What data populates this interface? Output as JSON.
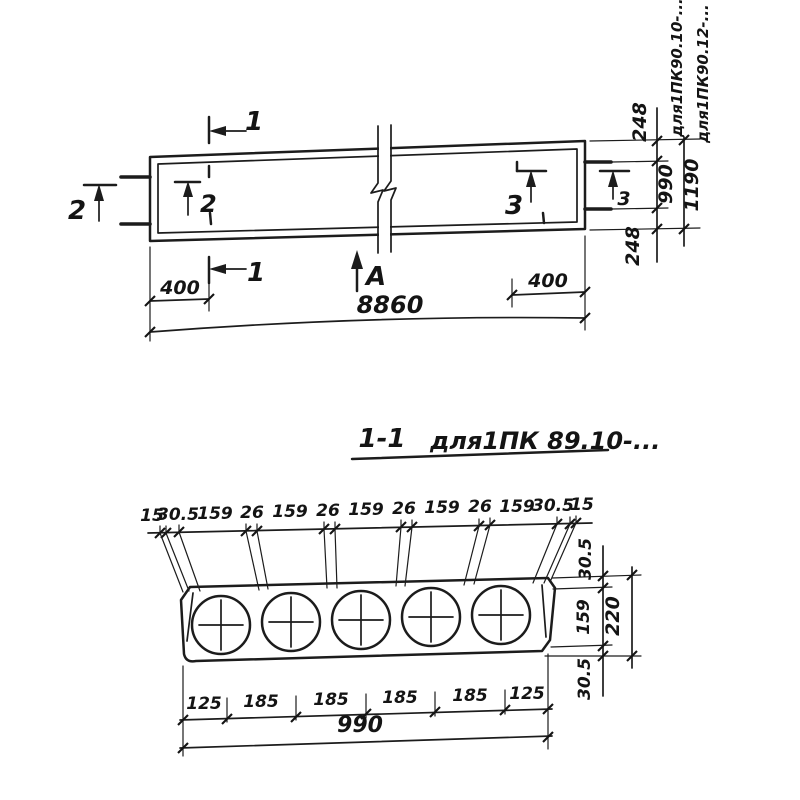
{
  "plan": {
    "marker1_top": "1",
    "marker1_bottom": "1",
    "marker2_outer": "2",
    "marker2_inner": "2",
    "marker3_inner": "3",
    "marker3_outer": "3",
    "view_arrow": "А",
    "dim_400_left": "400",
    "dim_400_right": "400",
    "dim_length": "8860",
    "dim_248_top": "248",
    "dim_990": "990",
    "dim_1190": "1190",
    "dim_248_bottom": "248",
    "note_series_990": "для1ПК90.10-...",
    "note_series_1190": "для1ПК90.12-..."
  },
  "section": {
    "title": "1-1",
    "title_note": "для1ПК 89.10-...",
    "top_dims": [
      "15",
      "30.5",
      "159",
      "26",
      "159",
      "26",
      "159",
      "26",
      "159",
      "26",
      "159",
      "30.5",
      "15"
    ],
    "right_dims": [
      "30.5",
      "159",
      "30.5"
    ],
    "dim_thickness": "220",
    "bottom_dims": [
      "125",
      "185",
      "185",
      "185",
      "185",
      "125"
    ],
    "dim_width": "990"
  }
}
